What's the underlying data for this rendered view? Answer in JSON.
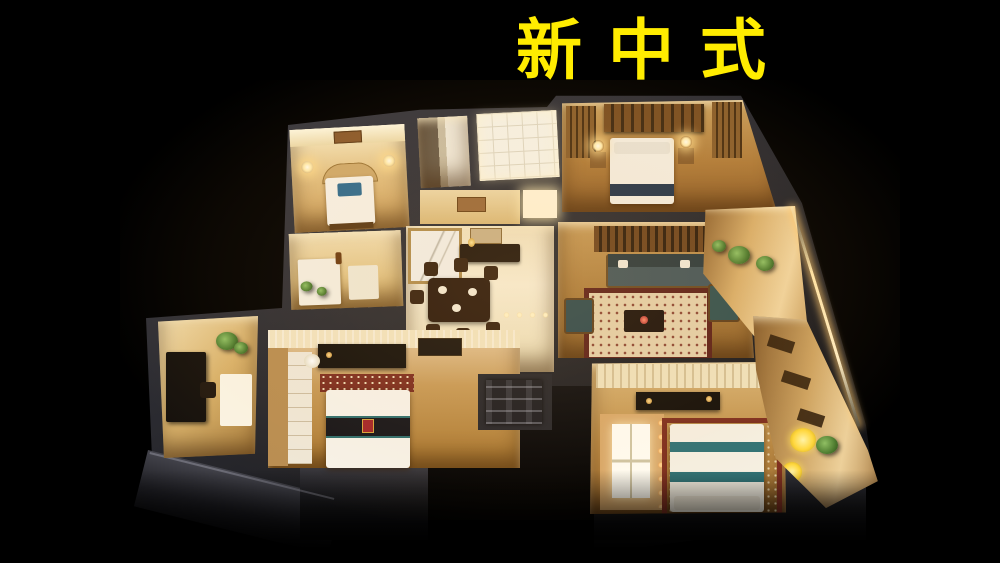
{
  "image_type": "photograph",
  "title": {
    "text": "新中式",
    "color": "#ffec00"
  },
  "scene": {
    "subject": "Illuminated miniature apartment floor-plan model photographed from above against a black background at night",
    "background_color": "#000000",
    "palette": {
      "warm_light": "#f6e2b0",
      "wood_floor": "#b07c3a",
      "wall_dark": "#2e2e34",
      "led_strip": "#ffdf9f",
      "bedding_white": "#f6f1e6",
      "accent_teal": "#2f7276",
      "accent_navy": "#24354a",
      "accent_blue": "#2f6b8e",
      "rug_red": "#7c2d20",
      "plant_green": "#5d8f3c",
      "flower_yellow": "#ffd83e"
    },
    "rooms": [
      {
        "name": "bedroom-northwest",
        "features": "bed with blue panel, arched headboard, wall lamps"
      },
      {
        "name": "bathroom",
        "features": "dark mirror wall and light tiles"
      },
      {
        "name": "white-tile-room",
        "features": "bright tiled walk-in area"
      },
      {
        "name": "master-bedroom",
        "features": "white bed with navy runner, lattice wardrobe, bedside lamps"
      },
      {
        "name": "living-room",
        "features": "dark sofa, ornate red-bordered rug, coffee table, lattice screen"
      },
      {
        "name": "dining-room",
        "features": "dark wood table with chairs, sideboard, marble wall panel, floor LEDs"
      },
      {
        "name": "kitchen",
        "features": "white counters with small plants"
      },
      {
        "name": "study",
        "features": "dark desk, white table, green plants"
      },
      {
        "name": "bedroom-southwest",
        "features": "white bed with black band and red-gold emblem, media console, wardrobe"
      },
      {
        "name": "bedroom-southeast",
        "features": "white bed with teal stripes, lit window nook with string lights, red patterned rug"
      },
      {
        "name": "balcony-east",
        "features": "potted plants, dark outdoor chairs, LED edge lighting"
      },
      {
        "name": "balcony-southeast",
        "features": "yellow flowers and greenery"
      },
      {
        "name": "entry",
        "features": "dark foyer with wall control panel"
      }
    ]
  }
}
